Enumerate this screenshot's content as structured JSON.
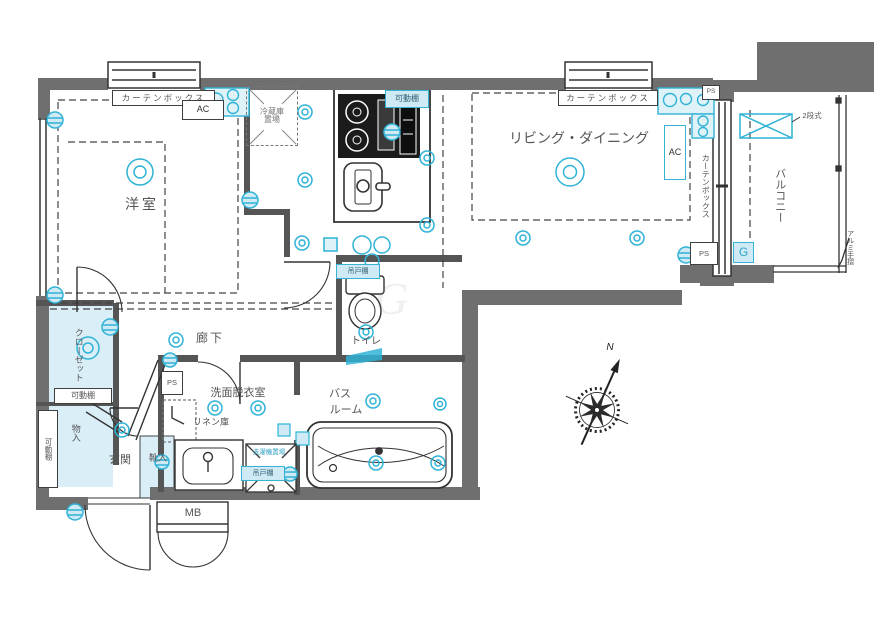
{
  "rooms": {
    "western_room": "洋室",
    "living_dining": "リビング・ダイニング",
    "balcony": "バルコニー",
    "hallway": "廊下",
    "washroom": "洗面脱衣室",
    "bath_line1": "バス",
    "bath_line2": "ルーム",
    "toilet": "トイレ",
    "entrance": "玄関",
    "closet": "クローゼット",
    "storage": "物入",
    "shoe_cabinet": "靴入",
    "linen": "リネン庫",
    "meter_box": "MB"
  },
  "labels": {
    "curtain_box": "カーテンボックス",
    "ac": "AC",
    "movable_shelf": "可動棚",
    "fridge_line1": "冷蔵庫",
    "fridge_line2": "置場",
    "washer_space": "洗濯機置場",
    "hanging_cupboard": "吊戸棚",
    "two_tier": "2段式",
    "alumi_rail": "アルミ手摺",
    "pipe_space": "PS",
    "gas": "G",
    "north": "N",
    "watermark": "G"
  },
  "colors": {
    "wall": "#6f6f6f",
    "line": "#333333",
    "accent": "#2fb3d6",
    "accent_fill": "#cfeaf4",
    "text": "#555555"
  }
}
